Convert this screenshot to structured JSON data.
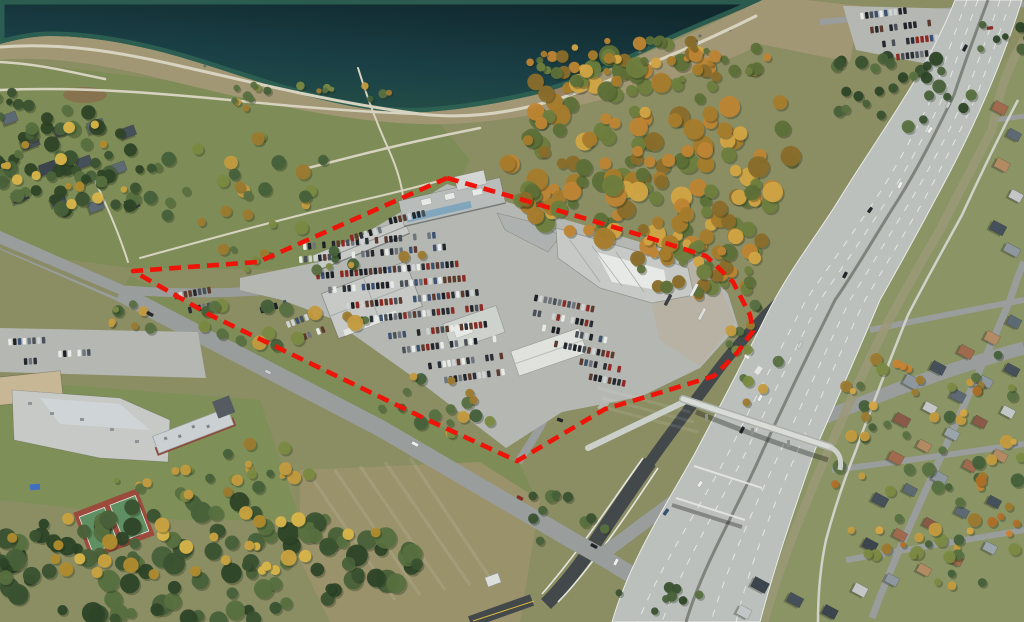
{
  "boundary": {
    "label": "site-boundary-outline",
    "color": "#ee1409",
    "stroke_width": 4.6,
    "dash_array": "12 7",
    "points": "447,178 520,199 640,235 706,256 733,282 750,315 753,331 737,353 714,376 649,396 605,409 517,461 430,421 320,368 210,315 133,271 258,262 447,178"
  },
  "palette": {
    "lake_deep": "#122d33",
    "lake_mid": "#1a4046",
    "lake_shore": "#2a564c",
    "sand": "#a29774",
    "park": "#7e8c57",
    "olive": "#8b8d63",
    "eastland": "#8a9465",
    "field": "#9a926b",
    "pavement": "#b5b7b2",
    "gravel": "#b7b2a4",
    "road": "#999d9c",
    "road_dark": "#43484b",
    "concrete": "#bcc0bc",
    "path": "#d8d3c0",
    "roof_light": "#c6c9c5",
    "roof_mid": "#aeb3b2",
    "roof_white": "#e7e9e6",
    "glass_blue": "#7fa6bd",
    "brick": "#8d4a3a",
    "tennis_red": "#9c4a3c",
    "tennis_green": "#5f8f62",
    "bin_blue": "#3f6fc0"
  },
  "scene": {
    "tree_palettes": [
      [
        "#bf8534",
        "#d2a544",
        "#a87c2c",
        "#6e7e3e",
        "#8a6d2a",
        "#5e7038"
      ],
      [
        "#3a5230",
        "#2e4527",
        "#49613a",
        "#57703f"
      ],
      [
        "#587041",
        "#7b8a42",
        "#c49b3f",
        "#46603a",
        "#9c7a30"
      ],
      [
        "#c9a23f",
        "#d9b54a",
        "#b08b2e"
      ],
      [
        "#c98334",
        "#d6a744",
        "#b06f28"
      ]
    ],
    "tree_clusters": [
      [
        648,
        150,
        148,
        108,
        170,
        11,
        0,
        5,
        11
      ],
      [
        703,
        252,
        72,
        48,
        55,
        22,
        0,
        4,
        9
      ],
      [
        660,
        63,
        132,
        24,
        48,
        33,
        0,
        3,
        7
      ],
      [
        300,
        96,
        92,
        15,
        18,
        44,
        2,
        2.5,
        5
      ],
      [
        258,
        182,
        122,
        50,
        26,
        55,
        2,
        4,
        8
      ],
      [
        330,
        258,
        122,
        18,
        14,
        66,
        2,
        3,
        7
      ],
      [
        75,
        165,
        86,
        56,
        58,
        77,
        1,
        4,
        8
      ],
      [
        60,
        160,
        80,
        50,
        14,
        88,
        3,
        3,
        6
      ],
      [
        282,
        320,
        92,
        28,
        16,
        99,
        2,
        4,
        8
      ],
      [
        432,
        400,
        72,
        25,
        12,
        110,
        2,
        3.5,
        7
      ],
      [
        250,
        468,
        62,
        26,
        14,
        121,
        2,
        3,
        7
      ],
      [
        200,
        564,
        218,
        64,
        120,
        132,
        1,
        5,
        11
      ],
      [
        182,
        542,
        202,
        42,
        30,
        143,
        3,
        4,
        8
      ],
      [
        756,
        352,
        28,
        56,
        14,
        154,
        2,
        3,
        6
      ],
      [
        940,
        462,
        118,
        132,
        70,
        165,
        2,
        3.5,
        7
      ],
      [
        932,
        470,
        112,
        122,
        18,
        176,
        4,
        3,
        6
      ],
      [
        893,
        88,
        86,
        40,
        30,
        187,
        1,
        3.5,
        7
      ],
      [
        1000,
        34,
        32,
        22,
        8,
        198,
        1,
        3,
        6
      ],
      [
        120,
        318,
        42,
        15,
        8,
        209,
        2,
        3,
        6
      ],
      [
        655,
        592,
        45,
        22,
        8,
        220,
        1,
        3,
        6
      ],
      [
        180,
        480,
        72,
        18,
        12,
        231,
        2,
        3,
        6
      ],
      [
        10,
        104,
        20,
        15,
        8,
        242,
        1,
        3,
        6
      ],
      [
        462,
        420,
        35,
        22,
        6,
        253,
        2,
        3,
        6
      ],
      [
        560,
        520,
        60,
        40,
        10,
        264,
        1,
        4,
        8
      ]
    ],
    "roof_colors": [
      "#5d6a74",
      "#8e979e",
      "#a06a4f",
      "#c2c6c7",
      "#46505a",
      "#7b8894",
      "#b28a63",
      "#3c444d",
      "#9aa5ab",
      "#8a5a48"
    ],
    "houses": [
      [
        1000,
        108,
        14,
        10,
        28,
        2
      ],
      [
        1014,
        135,
        13,
        9,
        28,
        0
      ],
      [
        1002,
        165,
        14,
        10,
        28,
        6
      ],
      [
        1016,
        196,
        13,
        9,
        28,
        3
      ],
      [
        998,
        228,
        15,
        10,
        28,
        4
      ],
      [
        1012,
        250,
        16,
        9,
        28,
        1
      ],
      [
        912,
        382,
        16,
        11,
        28,
        1
      ],
      [
        938,
        368,
        14,
        10,
        28,
        4
      ],
      [
        966,
        352,
        15,
        10,
        28,
        2
      ],
      [
        992,
        338,
        14,
        10,
        28,
        6
      ],
      [
        1014,
        322,
        13,
        10,
        28,
        0
      ],
      [
        902,
        420,
        15,
        10,
        28,
        9
      ],
      [
        930,
        408,
        13,
        9,
        28,
        3
      ],
      [
        958,
        396,
        14,
        10,
        28,
        0
      ],
      [
        986,
        382,
        13,
        9,
        28,
        1
      ],
      [
        1012,
        370,
        14,
        9,
        28,
        4
      ],
      [
        896,
        458,
        14,
        10,
        28,
        2
      ],
      [
        924,
        446,
        13,
        9,
        28,
        6
      ],
      [
        952,
        434,
        14,
        9,
        28,
        8
      ],
      [
        980,
        422,
        13,
        9,
        28,
        9
      ],
      [
        1008,
        412,
        13,
        9,
        28,
        3
      ],
      [
        880,
        500,
        15,
        10,
        28,
        4
      ],
      [
        910,
        490,
        13,
        9,
        28,
        0
      ],
      [
        940,
        478,
        14,
        10,
        28,
        1
      ],
      [
        970,
        466,
        13,
        9,
        28,
        2
      ],
      [
        1000,
        456,
        14,
        9,
        28,
        6
      ],
      [
        870,
        545,
        14,
        10,
        28,
        7
      ],
      [
        900,
        535,
        13,
        9,
        28,
        2
      ],
      [
        930,
        524,
        13,
        9,
        28,
        9
      ],
      [
        962,
        512,
        13,
        9,
        28,
        0
      ],
      [
        994,
        502,
        13,
        9,
        28,
        4
      ],
      [
        860,
        590,
        14,
        10,
        28,
        3
      ],
      [
        892,
        580,
        13,
        9,
        28,
        1
      ],
      [
        924,
        570,
        13,
        9,
        28,
        6
      ],
      [
        956,
        560,
        13,
        9,
        28,
        2
      ],
      [
        990,
        548,
        13,
        9,
        28,
        8
      ],
      [
        760,
        585,
        16,
        11,
        28,
        7
      ],
      [
        795,
        600,
        15,
        10,
        28,
        4
      ],
      [
        830,
        612,
        14,
        10,
        28,
        7
      ],
      [
        744,
        612,
        13,
        10,
        28,
        3
      ],
      [
        30,
        142,
        18,
        12,
        -20,
        4
      ],
      [
        62,
        130,
        16,
        11,
        -20,
        7
      ],
      [
        96,
        126,
        17,
        11,
        -20,
        0
      ],
      [
        128,
        132,
        15,
        10,
        -20,
        4
      ],
      [
        48,
        168,
        17,
        11,
        -20,
        7
      ],
      [
        84,
        162,
        15,
        10,
        -20,
        4
      ],
      [
        118,
        168,
        16,
        10,
        -20,
        0
      ],
      [
        20,
        196,
        16,
        11,
        -20,
        7
      ],
      [
        58,
        200,
        15,
        10,
        -20,
        4
      ],
      [
        96,
        206,
        15,
        10,
        -20,
        0
      ],
      [
        132,
        204,
        14,
        10,
        -20,
        7
      ],
      [
        10,
        118,
        14,
        10,
        -20,
        0
      ]
    ],
    "car_colors": [
      "#2b3036",
      "#4a5057",
      "#23272c",
      "#8d2a24",
      "#cfd2d2",
      "#3c5272",
      "#1d2126",
      "#6e747b",
      "#e8eae8",
      "#5d3a2e"
    ],
    "parking_rows": [
      [
        300,
        247,
        -5,
        30,
        1
      ],
      [
        296,
        260,
        -5,
        32,
        2
      ],
      [
        318,
        276,
        -5,
        30,
        3
      ],
      [
        330,
        290,
        -5,
        30,
        4
      ],
      [
        348,
        306,
        -6,
        28,
        5
      ],
      [
        362,
        320,
        -6,
        26,
        6
      ],
      [
        390,
        336,
        -7,
        22,
        7
      ],
      [
        404,
        350,
        -7,
        20,
        8
      ],
      [
        430,
        366,
        -8,
        16,
        9
      ],
      [
        446,
        380,
        -8,
        13,
        10
      ],
      [
        536,
        298,
        11,
        13,
        11
      ],
      [
        530,
        312,
        11,
        15,
        12
      ],
      [
        544,
        328,
        11,
        14,
        13
      ],
      [
        556,
        344,
        11,
        13,
        14
      ],
      [
        572,
        360,
        11,
        11,
        15
      ],
      [
        586,
        376,
        11,
        9,
        16
      ],
      [
        386,
        222,
        -13,
        9,
        17
      ],
      [
        352,
        238,
        -16,
        7,
        18
      ],
      [
        284,
        326,
        -21,
        8,
        19
      ],
      [
        296,
        340,
        -21,
        7,
        20
      ],
      [
        262,
        310,
        -16,
        6,
        21
      ],
      [
        176,
        296,
        -10,
        8,
        22
      ],
      [
        190,
        310,
        -12,
        7,
        23
      ],
      [
        10,
        342,
        -3,
        8,
        24
      ],
      [
        60,
        354,
        -3,
        7,
        25
      ],
      [
        16,
        362,
        -3,
        6,
        26
      ],
      [
        862,
        16,
        -7,
        11,
        27
      ],
      [
        872,
        30,
        -7,
        13,
        28
      ],
      [
        884,
        44,
        -7,
        12,
        29
      ],
      [
        898,
        57,
        -7,
        9,
        30
      ]
    ],
    "vehicles": [
      [
        150,
        314,
        27,
        7,
        "#22262b"
      ],
      [
        268,
        372,
        27,
        6.5,
        "#c8cbcc"
      ],
      [
        415,
        444,
        27,
        7,
        "#eef0ee"
      ],
      [
        520,
        498,
        27,
        6.5,
        "#8d2a24"
      ],
      [
        594,
        546,
        27,
        7,
        "#22262b"
      ],
      [
        616,
        562,
        -62,
        7,
        "#eef0ee"
      ],
      [
        666,
        512,
        -55,
        7,
        "#33506e"
      ],
      [
        700,
        484,
        -55,
        6.5,
        "#eef0ee"
      ],
      [
        742,
        430,
        -62,
        7,
        "#22262b"
      ],
      [
        760,
        398,
        -62,
        6.5,
        "#eef0ee"
      ],
      [
        800,
        345,
        -62,
        7,
        "#c8cbcc"
      ],
      [
        845,
        275,
        -62,
        6.5,
        "#22262b"
      ],
      [
        900,
        185,
        -62,
        7,
        "#eef0ee"
      ],
      [
        948,
        105,
        -62,
        6.5,
        "#c8cbcc"
      ],
      [
        965,
        48,
        -62,
        7,
        "#22262b"
      ],
      [
        930,
        130,
        -55,
        6.5,
        "#eef0ee"
      ],
      [
        870,
        210,
        -55,
        6,
        "#22262b"
      ],
      [
        694,
        290,
        -62,
        14,
        "#e8eae7"
      ],
      [
        702,
        314,
        -62,
        13,
        "#dcded9"
      ],
      [
        668,
        300,
        -62,
        12,
        "#3a3f44"
      ],
      [
        560,
        420,
        20,
        6,
        "#22262b"
      ],
      [
        990,
        28,
        -8,
        6,
        "#8d2a24"
      ]
    ]
  }
}
